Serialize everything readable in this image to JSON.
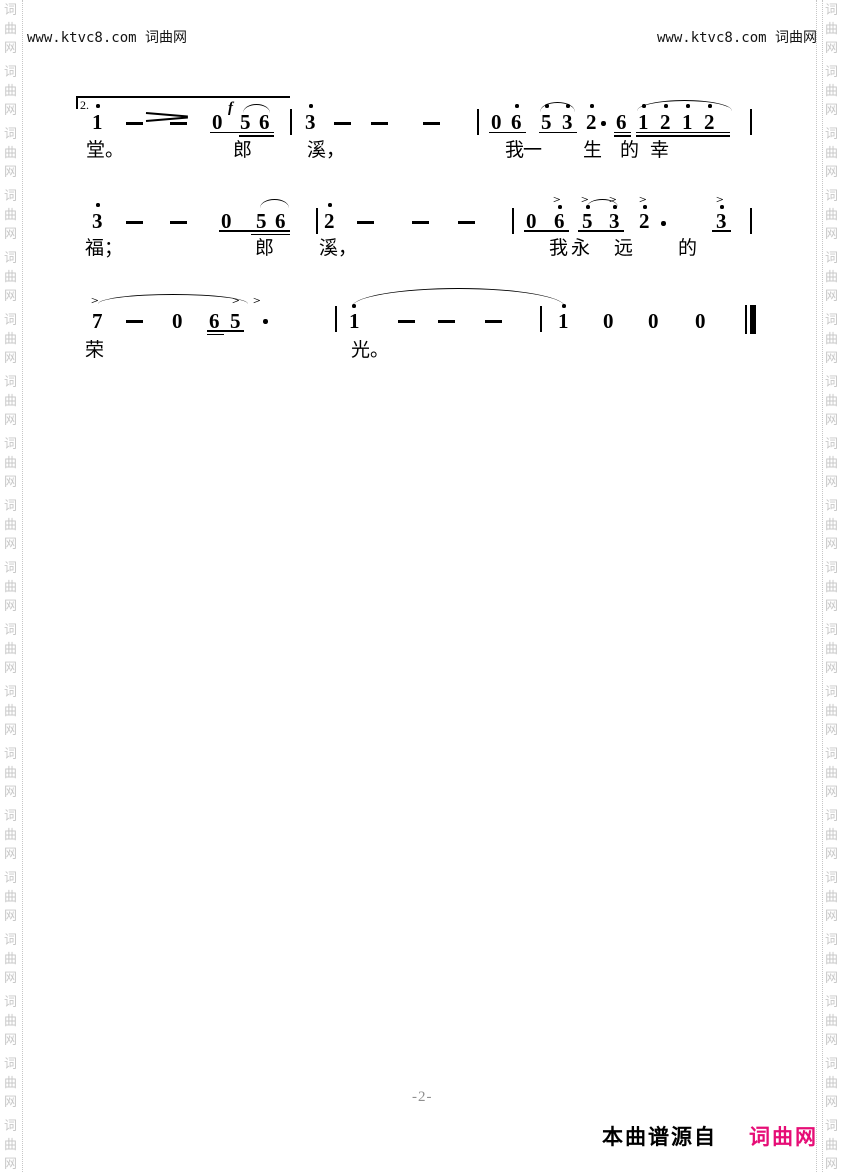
{
  "page": {
    "header_left": "www.ktvc8.com 词曲网",
    "header_right": "www.ktvc8.com 词曲网",
    "page_number": "-2-",
    "footer_source_label": "本曲谱源自",
    "footer_site": "词曲网",
    "colors": {
      "site_pink": "#e60d76",
      "watermark_gray": "#c8c8c8",
      "page_number_gray": "#8f8f8f",
      "ink": "#000000"
    }
  },
  "watermark": {
    "chars": [
      "词",
      "曲",
      "网"
    ],
    "groups": 19,
    "start_y": 4,
    "char_step": 19,
    "group_step": 62,
    "left_col_x": 4,
    "right_col_x": 825,
    "divider_xs": [
      22,
      816,
      822
    ]
  },
  "score": {
    "texts": [
      {
        "t": "2.",
        "x": 80,
        "y": 98,
        "c": "volta",
        "n": "volta-number"
      },
      {
        "t": "f",
        "x": 228,
        "y": 100,
        "c": "dyn",
        "n": "dynamic-forte"
      },
      {
        "t": "1",
        "x": 92,
        "y": 111,
        "c": "note",
        "n": "note"
      },
      {
        "t": "0",
        "x": 212,
        "y": 111,
        "c": "note",
        "n": "note"
      },
      {
        "t": "5",
        "x": 240,
        "y": 111,
        "c": "note",
        "n": "note"
      },
      {
        "t": "6",
        "x": 259,
        "y": 111,
        "c": "note",
        "n": "note"
      },
      {
        "t": "3",
        "x": 305,
        "y": 111,
        "c": "note",
        "n": "note"
      },
      {
        "t": "0",
        "x": 491,
        "y": 111,
        "c": "note",
        "n": "note"
      },
      {
        "t": "6",
        "x": 511,
        "y": 111,
        "c": "note",
        "n": "note"
      },
      {
        "t": "5",
        "x": 541,
        "y": 111,
        "c": "note",
        "n": "note"
      },
      {
        "t": "3",
        "x": 562,
        "y": 111,
        "c": "note",
        "n": "note"
      },
      {
        "t": "2",
        "x": 586,
        "y": 111,
        "c": "note",
        "n": "note"
      },
      {
        "t": "6",
        "x": 616,
        "y": 111,
        "c": "note",
        "n": "note"
      },
      {
        "t": "1",
        "x": 638,
        "y": 111,
        "c": "note",
        "n": "note"
      },
      {
        "t": "2",
        "x": 660,
        "y": 111,
        "c": "note",
        "n": "note"
      },
      {
        "t": "1",
        "x": 682,
        "y": 111,
        "c": "note",
        "n": "note"
      },
      {
        "t": "2",
        "x": 704,
        "y": 111,
        "c": "note",
        "n": "note"
      },
      {
        "t": "3",
        "x": 92,
        "y": 210,
        "c": "note",
        "n": "note"
      },
      {
        "t": "0",
        "x": 221,
        "y": 210,
        "c": "note",
        "n": "note"
      },
      {
        "t": "5",
        "x": 256,
        "y": 210,
        "c": "note",
        "n": "note"
      },
      {
        "t": "6",
        "x": 275,
        "y": 210,
        "c": "note",
        "n": "note"
      },
      {
        "t": "2",
        "x": 324,
        "y": 210,
        "c": "note",
        "n": "note"
      },
      {
        "t": "0",
        "x": 526,
        "y": 210,
        "c": "note",
        "n": "note"
      },
      {
        "t": "6",
        "x": 554,
        "y": 210,
        "c": "note",
        "n": "note"
      },
      {
        "t": "5",
        "x": 582,
        "y": 210,
        "c": "note",
        "n": "note"
      },
      {
        "t": "3",
        "x": 609,
        "y": 210,
        "c": "note",
        "n": "note"
      },
      {
        "t": "2",
        "x": 639,
        "y": 210,
        "c": "note",
        "n": "note"
      },
      {
        "t": "3",
        "x": 716,
        "y": 210,
        "c": "note",
        "n": "note"
      },
      {
        "t": "7",
        "x": 92,
        "y": 310,
        "c": "note",
        "n": "note"
      },
      {
        "t": "0",
        "x": 172,
        "y": 310,
        "c": "note",
        "n": "note"
      },
      {
        "t": "6",
        "x": 209,
        "y": 310,
        "c": "note",
        "n": "note"
      },
      {
        "t": "5",
        "x": 230,
        "y": 310,
        "c": "note",
        "n": "note"
      },
      {
        "t": "1",
        "x": 349,
        "y": 310,
        "c": "note",
        "n": "note"
      },
      {
        "t": "1",
        "x": 558,
        "y": 310,
        "c": "note",
        "n": "note"
      },
      {
        "t": "0",
        "x": 603,
        "y": 310,
        "c": "note",
        "n": "note"
      },
      {
        "t": "0",
        "x": 648,
        "y": 310,
        "c": "note",
        "n": "note"
      },
      {
        "t": "0",
        "x": 695,
        "y": 310,
        "c": "note",
        "n": "note"
      },
      {
        "t": ">",
        "x": 554,
        "y": 196,
        "c": "accent",
        "n": "accent-mark"
      },
      {
        "t": ">",
        "x": 582,
        "y": 196,
        "c": "accent",
        "n": "accent-mark"
      },
      {
        "t": ">",
        "x": 610,
        "y": 196,
        "c": "accent",
        "n": "accent-mark"
      },
      {
        "t": ">",
        "x": 640,
        "y": 196,
        "c": "accent",
        "n": "accent-mark"
      },
      {
        "t": ">",
        "x": 717,
        "y": 196,
        "c": "accent",
        "n": "accent-mark"
      },
      {
        "t": ">",
        "x": 92,
        "y": 297,
        "c": "accent",
        "n": "accent-mark"
      },
      {
        "t": ">",
        "x": 233,
        "y": 297,
        "c": "accent",
        "n": "accent-mark"
      },
      {
        "t": ">",
        "x": 254,
        "y": 297,
        "c": "accent",
        "n": "accent-mark"
      },
      {
        "t": "堂。",
        "x": 86,
        "y": 141,
        "c": "lyric",
        "n": "lyric"
      },
      {
        "t": "郎",
        "x": 233,
        "y": 141,
        "c": "lyric",
        "n": "lyric"
      },
      {
        "t": "溪，",
        "x": 307,
        "y": 141,
        "c": "lyric",
        "n": "lyric"
      },
      {
        "t": "我",
        "x": 505,
        "y": 141,
        "c": "lyric",
        "n": "lyric"
      },
      {
        "t": "一",
        "x": 523,
        "y": 141,
        "c": "lyric",
        "n": "lyric"
      },
      {
        "t": "生",
        "x": 583,
        "y": 141,
        "c": "lyric",
        "n": "lyric"
      },
      {
        "t": "的",
        "x": 620,
        "y": 141,
        "c": "lyric",
        "n": "lyric"
      },
      {
        "t": "幸",
        "x": 650,
        "y": 141,
        "c": "lyric",
        "n": "lyric"
      },
      {
        "t": "福；",
        "x": 85,
        "y": 239,
        "c": "lyric",
        "n": "lyric"
      },
      {
        "t": "郎",
        "x": 255,
        "y": 239,
        "c": "lyric",
        "n": "lyric"
      },
      {
        "t": "溪，",
        "x": 319,
        "y": 239,
        "c": "lyric",
        "n": "lyric"
      },
      {
        "t": "我",
        "x": 549,
        "y": 239,
        "c": "lyric",
        "n": "lyric"
      },
      {
        "t": "永",
        "x": 571,
        "y": 239,
        "c": "lyric",
        "n": "lyric"
      },
      {
        "t": "远",
        "x": 614,
        "y": 239,
        "c": "lyric",
        "n": "lyric"
      },
      {
        "t": "的",
        "x": 678,
        "y": 239,
        "c": "lyric",
        "n": "lyric"
      },
      {
        "t": "荣",
        "x": 85,
        "y": 341,
        "c": "lyric",
        "n": "lyric"
      },
      {
        "t": "光。",
        "x": 351,
        "y": 341,
        "c": "lyric",
        "n": "lyric"
      }
    ],
    "dots": [
      {
        "x": 96,
        "y": 104,
        "n": "octave-dot"
      },
      {
        "x": 309,
        "y": 104,
        "n": "octave-dot"
      },
      {
        "x": 515,
        "y": 104,
        "n": "octave-dot"
      },
      {
        "x": 545,
        "y": 104,
        "n": "octave-dot"
      },
      {
        "x": 566,
        "y": 104,
        "n": "octave-dot"
      },
      {
        "x": 590,
        "y": 104,
        "n": "octave-dot"
      },
      {
        "x": 642,
        "y": 104,
        "n": "octave-dot"
      },
      {
        "x": 664,
        "y": 104,
        "n": "octave-dot"
      },
      {
        "x": 686,
        "y": 104,
        "n": "octave-dot"
      },
      {
        "x": 708,
        "y": 104,
        "n": "octave-dot"
      },
      {
        "x": 96,
        "y": 203,
        "n": "octave-dot"
      },
      {
        "x": 328,
        "y": 203,
        "n": "octave-dot"
      },
      {
        "x": 558,
        "y": 205,
        "n": "octave-dot"
      },
      {
        "x": 586,
        "y": 205,
        "n": "octave-dot"
      },
      {
        "x": 613,
        "y": 205,
        "n": "octave-dot"
      },
      {
        "x": 643,
        "y": 205,
        "n": "octave-dot"
      },
      {
        "x": 720,
        "y": 205,
        "n": "octave-dot"
      },
      {
        "x": 352,
        "y": 304,
        "n": "octave-dot"
      },
      {
        "x": 562,
        "y": 304,
        "n": "octave-dot"
      },
      {
        "x": 601,
        "y": 121,
        "b": 1,
        "n": "augmentation-dot"
      },
      {
        "x": 661,
        "y": 221,
        "b": 1,
        "n": "augmentation-dot"
      },
      {
        "x": 263,
        "y": 319,
        "b": 1,
        "n": "augmentation-dot"
      }
    ],
    "rules": [
      {
        "x": 76,
        "y": 96,
        "w": 214,
        "h": 1.5,
        "n": "volta-line"
      },
      {
        "x": 76,
        "y": 96,
        "w": 1.5,
        "h": 13,
        "n": "volta-tick"
      },
      {
        "x": 126,
        "y": 122,
        "w": 17,
        "h": 3,
        "n": "dash"
      },
      {
        "x": 170,
        "y": 122,
        "w": 17,
        "h": 3,
        "n": "dash"
      },
      {
        "x": 334,
        "y": 122,
        "w": 17,
        "h": 3,
        "n": "dash"
      },
      {
        "x": 371,
        "y": 122,
        "w": 17,
        "h": 3,
        "n": "dash"
      },
      {
        "x": 423,
        "y": 122,
        "w": 17,
        "h": 3,
        "n": "dash"
      },
      {
        "x": 126,
        "y": 221,
        "w": 17,
        "h": 3,
        "n": "dash"
      },
      {
        "x": 170,
        "y": 221,
        "w": 17,
        "h": 3,
        "n": "dash"
      },
      {
        "x": 357,
        "y": 221,
        "w": 17,
        "h": 3,
        "n": "dash"
      },
      {
        "x": 412,
        "y": 221,
        "w": 17,
        "h": 3,
        "n": "dash"
      },
      {
        "x": 458,
        "y": 221,
        "w": 17,
        "h": 3,
        "n": "dash"
      },
      {
        "x": 126,
        "y": 320,
        "w": 17,
        "h": 3,
        "n": "dash"
      },
      {
        "x": 398,
        "y": 320,
        "w": 17,
        "h": 3,
        "n": "dash"
      },
      {
        "x": 438,
        "y": 320,
        "w": 17,
        "h": 3,
        "n": "dash"
      },
      {
        "x": 485,
        "y": 320,
        "w": 17,
        "h": 3,
        "n": "dash"
      },
      {
        "x": 290,
        "y": 109,
        "w": 2,
        "h": 26,
        "n": "barline"
      },
      {
        "x": 477,
        "y": 109,
        "w": 2,
        "h": 26,
        "n": "barline"
      },
      {
        "x": 750,
        "y": 109,
        "w": 2,
        "h": 26,
        "n": "barline"
      },
      {
        "x": 316,
        "y": 208,
        "w": 2,
        "h": 26,
        "n": "barline"
      },
      {
        "x": 512,
        "y": 208,
        "w": 2,
        "h": 26,
        "n": "barline"
      },
      {
        "x": 750,
        "y": 208,
        "w": 2,
        "h": 26,
        "n": "barline"
      },
      {
        "x": 335,
        "y": 306,
        "w": 2,
        "h": 26,
        "n": "barline"
      },
      {
        "x": 540,
        "y": 306,
        "w": 2,
        "h": 26,
        "n": "barline"
      },
      {
        "x": 745,
        "y": 305,
        "w": 1.5,
        "h": 29,
        "n": "final-barline-thin"
      },
      {
        "x": 750,
        "y": 305,
        "w": 5.5,
        "h": 29,
        "n": "final-barline-thick"
      },
      {
        "x": 210,
        "y": 131.5,
        "w": 64,
        "h": 1.8,
        "n": "underline"
      },
      {
        "x": 239,
        "y": 135,
        "w": 35,
        "h": 1.8,
        "n": "underline"
      },
      {
        "x": 489,
        "y": 131.5,
        "w": 37,
        "h": 1.8,
        "n": "underline"
      },
      {
        "x": 539,
        "y": 131.5,
        "w": 38,
        "h": 1.8,
        "n": "underline"
      },
      {
        "x": 614,
        "y": 131.5,
        "w": 17,
        "h": 1.8,
        "n": "underline"
      },
      {
        "x": 614,
        "y": 135,
        "w": 17,
        "h": 1.8,
        "n": "underline"
      },
      {
        "x": 636,
        "y": 131.5,
        "w": 94,
        "h": 1.8,
        "n": "underline"
      },
      {
        "x": 636,
        "y": 135,
        "w": 94,
        "h": 1.8,
        "n": "underline"
      },
      {
        "x": 219,
        "y": 230,
        "w": 71,
        "h": 1.8,
        "n": "underline"
      },
      {
        "x": 251,
        "y": 233.5,
        "w": 39,
        "h": 1.8,
        "n": "underline"
      },
      {
        "x": 524,
        "y": 230,
        "w": 45,
        "h": 1.8,
        "n": "underline"
      },
      {
        "x": 578,
        "y": 230,
        "w": 46,
        "h": 1.8,
        "n": "underline"
      },
      {
        "x": 712,
        "y": 230,
        "w": 19,
        "h": 1.8,
        "n": "underline"
      },
      {
        "x": 207,
        "y": 330,
        "w": 37,
        "h": 1.8,
        "n": "underline"
      },
      {
        "x": 207,
        "y": 333.5,
        "w": 17,
        "h": 1.8,
        "n": "underline"
      }
    ],
    "arcs": [
      {
        "x": 243,
        "y": 104,
        "w": 27,
        "h": 8,
        "n": "slur"
      },
      {
        "x": 540,
        "y": 102,
        "w": 35,
        "h": 9,
        "n": "slur"
      },
      {
        "x": 637,
        "y": 100,
        "w": 95,
        "h": 10,
        "n": "slur"
      },
      {
        "x": 260,
        "y": 199,
        "w": 29,
        "h": 8,
        "n": "slur"
      },
      {
        "x": 587,
        "y": 199,
        "w": 31,
        "h": 7,
        "n": "slur"
      },
      {
        "x": 98,
        "y": 294,
        "w": 150,
        "h": 9,
        "n": "phrase-slur"
      },
      {
        "x": 352,
        "y": 288,
        "w": 213,
        "h": 18,
        "n": "tie"
      }
    ],
    "segs": [
      {
        "x": 146,
        "y": 112,
        "w": 42,
        "deg": 4.8,
        "n": "hairpin-line"
      },
      {
        "x": 146,
        "y": 119.5,
        "w": 42,
        "deg": -4.8,
        "n": "hairpin-line"
      }
    ]
  }
}
